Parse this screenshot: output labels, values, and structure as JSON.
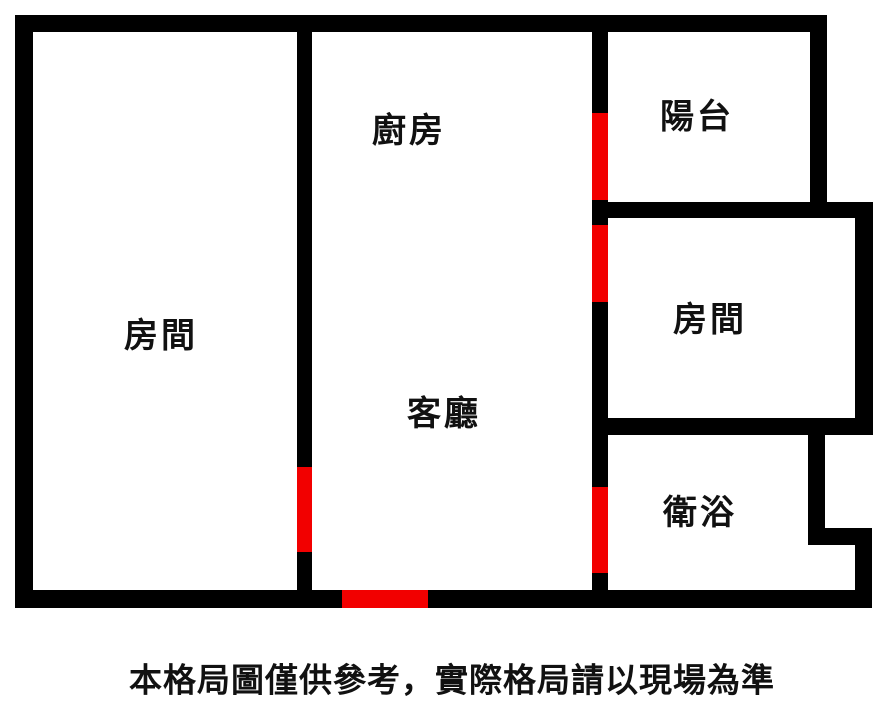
{
  "title": "apartment-floor-plan",
  "colors": {
    "background": "#ffffff",
    "wall": "#000000",
    "door": "#f20000",
    "text": "#111111"
  },
  "floorplan": {
    "rooms": [
      {
        "id": "room-left",
        "label": "房間"
      },
      {
        "id": "kitchen",
        "label": "廚房"
      },
      {
        "id": "living-room",
        "label": "客廳"
      },
      {
        "id": "balcony",
        "label": "陽台"
      },
      {
        "id": "room-right",
        "label": "房間"
      },
      {
        "id": "bathroom",
        "label": "衛浴"
      }
    ],
    "doors": [
      {
        "id": "door-kitchen-balcony",
        "connects": "廚房-陽台"
      },
      {
        "id": "door-kitchen-room",
        "connects": "廚房-房間"
      },
      {
        "id": "door-living-room-left",
        "connects": "客廳-房間"
      },
      {
        "id": "door-living-bathroom",
        "connects": "客廳-衛浴"
      },
      {
        "id": "door-main-entrance",
        "connects": "客廳-入口"
      }
    ]
  },
  "caption": {
    "text": "本格局圖僅供參考，實際格局請以現場為準"
  }
}
